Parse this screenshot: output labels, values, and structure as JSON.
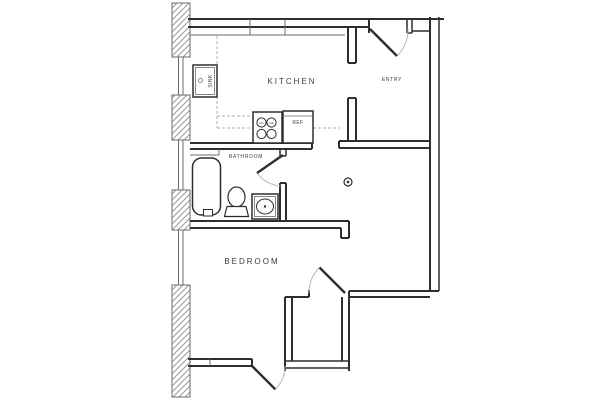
{
  "rooms": {
    "kitchen": {
      "label": "KITCHEN"
    },
    "entry": {
      "label": "ENTRY"
    },
    "bathroom": {
      "label": "BATHROOM"
    },
    "bedroom": {
      "label": "BEDROOM"
    }
  },
  "fixtures": {
    "kitchen_sink": {
      "label": "SINK"
    },
    "refrigerator": {
      "label": "REF"
    },
    "range": {
      "label_left": "RA",
      "label_right": "GE"
    }
  },
  "symbols": {
    "floor_symbol": "circle-with-center-dot"
  },
  "colors": {
    "wall": "#2e2e2e",
    "thin_line": "#6b6b6b",
    "hatch": "#9a9a9a",
    "counter_dash": "#b0b0b0",
    "door_arc": "#b8b8b8",
    "text": "#3c3c3c",
    "background": "#ffffff"
  }
}
